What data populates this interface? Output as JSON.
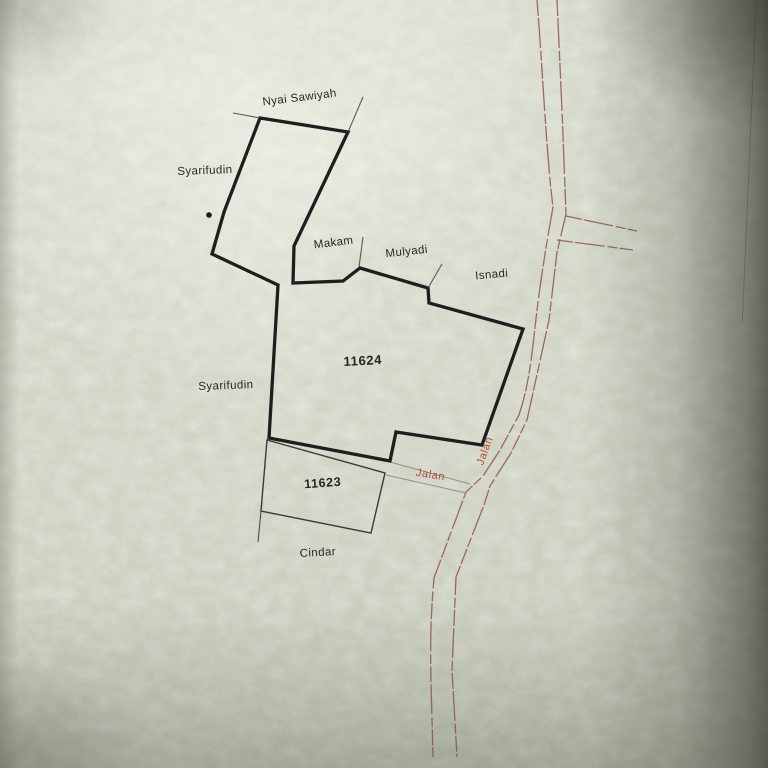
{
  "map": {
    "labels": {
      "nyai_sawiyah": "Nyai Sawiyah",
      "syarifudin_north": "Syarifudin",
      "makam": "Makam",
      "mulyadi": "Mulyadi",
      "isnadi": "Isnadi",
      "parcel_large_id": "11624",
      "syarifudin_west": "Syarifudin",
      "parcel_small_id": "11623",
      "cindar": "Cindar",
      "jalan_east_west": "Jalan",
      "jalan_north_south": "Jalan"
    },
    "colors": {
      "ink_black": "#262626",
      "boundary_black": "#1e1e1e",
      "thin_line_black": "#4a4a4a",
      "road_red": "#94544b",
      "jalan_label_red": "#b5493d",
      "paper_base": "#cbd0c0"
    }
  }
}
